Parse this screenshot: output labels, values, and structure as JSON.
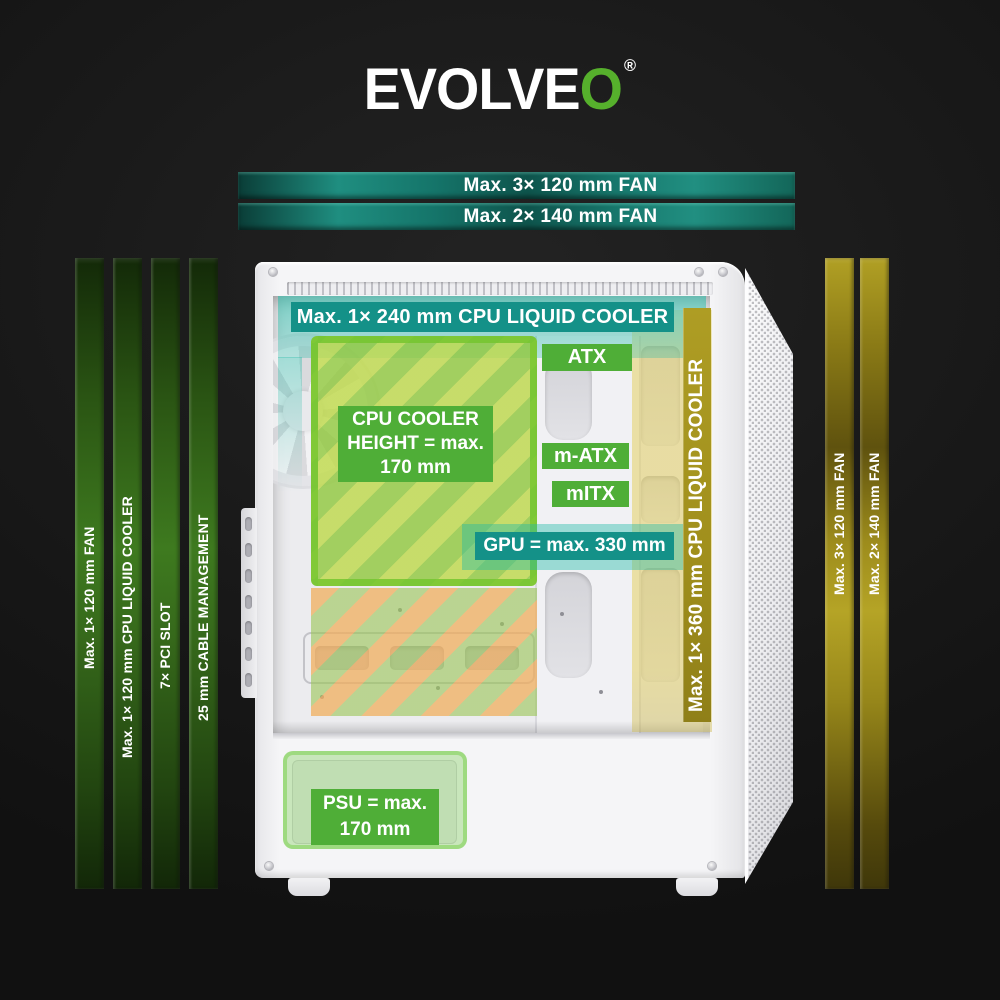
{
  "brand": {
    "logo_text": "EVOLVE",
    "logo_accent": "O",
    "registered": "®",
    "accent_color": "#56b02c"
  },
  "colors": {
    "background": "#1a1a1a",
    "teal_solid": "#149188",
    "teal_translucent": "rgba(34,186,166,0.45)",
    "label_green": "#4fae37",
    "stripe_yellow_green": "#bcd948",
    "stripe_green": "#90c83c",
    "stripe_orange": "#f0ae5e",
    "olive_bar": "#a5941f",
    "banner_green": "#3e7a1f",
    "banner_yellow": "#a8961e",
    "case_white": "#f5f5f7"
  },
  "top_banners": [
    "Max. 3× 120 mm FAN",
    "Max. 2× 140 mm FAN"
  ],
  "left_banners": [
    "Max. 1× 120 mm FAN",
    "Max. 1× 120 mm CPU LIQUID COOLER",
    "7× PCI SLOT",
    "25 mm CABLE MANAGEMENT"
  ],
  "right_banners": [
    "Max. 3× 120 mm FAN",
    "Max. 2× 140 mm FAN"
  ],
  "case_overlays": {
    "top_liquid_cooler": "Max. 1× 240 mm CPU LIQUID COOLER",
    "atx": "ATX",
    "m_atx": "m-ATX",
    "mitx": "mITX",
    "cpu_cooler_lines": [
      "CPU COOLER",
      "HEIGHT = max.",
      "170 mm"
    ],
    "gpu": "GPU = max. 330 mm",
    "front_liquid_cooler": "Max. 1× 360 mm CPU LIQUID COOLER",
    "psu_lines": [
      "PSU = max.",
      "170 mm"
    ]
  }
}
